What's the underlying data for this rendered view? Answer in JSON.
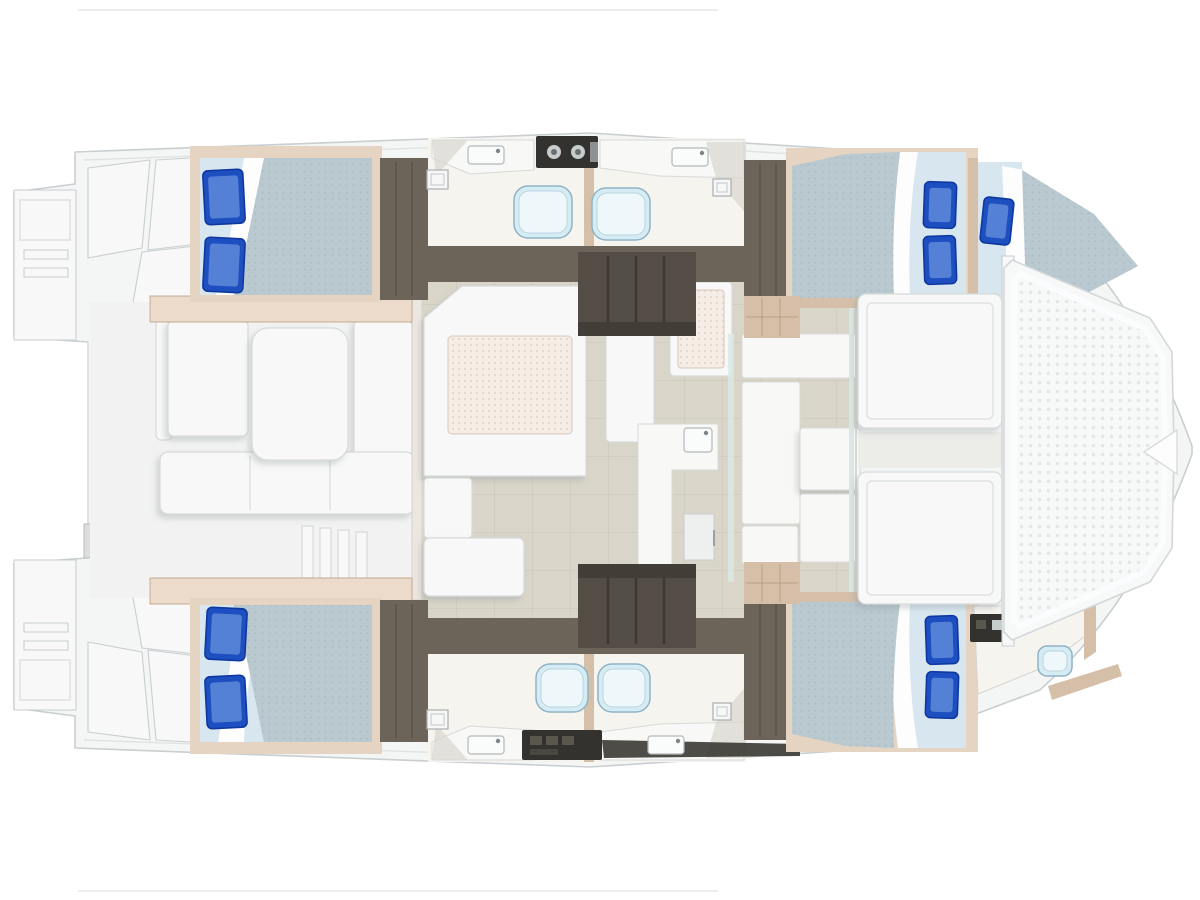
{
  "diagram": {
    "type": "yacht-floor-plan",
    "description": "Top-down interior layout plan of a sailing catamaran, bow to the right",
    "orientation": {
      "bow": "right",
      "stern": "left"
    },
    "rooms": [
      {
        "id": "aft-cockpit",
        "desc": "aft cockpit with table, benches and transom steps"
      },
      {
        "id": "salon",
        "desc": "salon with U-shaped settee and table"
      },
      {
        "id": "galley",
        "desc": "galley counters with sink and refrigerator"
      },
      {
        "id": "port-aft-cabin",
        "desc": "double berth with two pillows"
      },
      {
        "id": "port-heads",
        "desc": "two bathroom compartments with toilets and basins"
      },
      {
        "id": "port-forward-cabin",
        "desc": "double berth with two pillows"
      },
      {
        "id": "port-forepeak-berth",
        "desc": "single berth with one pillow"
      },
      {
        "id": "starboard-aft-cabin",
        "desc": "double berth with two pillows"
      },
      {
        "id": "starboard-heads",
        "desc": "two bathroom compartments with toilets and basins"
      },
      {
        "id": "starboard-forward-cabin",
        "desc": "double berth with two pillows"
      },
      {
        "id": "starboard-forward-head",
        "desc": "small bathroom with toilet and vanity"
      },
      {
        "id": "forward-cockpit",
        "desc": "forward cockpit with two lounge pads"
      },
      {
        "id": "trampoline",
        "desc": "bow trampoline net"
      }
    ]
  },
  "palette": {
    "background": "#ffffff",
    "hull_fill": "#f4f5f5",
    "hull_stroke": "#c9ced1",
    "panel_line": "#dfe2e3",
    "deck_white": "#f7f8f7",
    "cockpit_sole": "#f1f2f1",
    "taupe": "#6d6459",
    "taupe_dark": "#544d45",
    "step_line": "#3c3731",
    "wood_light": "#e6d4c3",
    "wood_mid": "#d5bfa9",
    "wood_dark": "#b99c80",
    "trim_pink": "#ecdacb",
    "floor_beige": "#d9d5c9",
    "floor_grid": "#c8c4b7",
    "bathroom_floor": "#f6f4ef",
    "bath_wedge": "#d9d5cf",
    "mattress_pale": "#d7e6ef",
    "duvet": "#b9c9cf",
    "duvet_dot": "#a9bcc3",
    "sheet": "#fdfdfe",
    "pillow": "#1d4fc0",
    "pillow_dark": "#0f37a0",
    "pillow_light": "#5e8ad8",
    "toilet_fill": "#d6ecf5",
    "toilet_stroke": "#8fb3c4",
    "toilet_lid": "#eef8fb",
    "counter_white": "#f8f8f6",
    "counter_stroke": "#d6dad9",
    "stove_dark": "#34322e",
    "knob": "#c7cccd",
    "table_pad": "#f4ece5",
    "table_dot": "#e3d2c6",
    "table_stroke": "#d8c9ba",
    "tramp_fill": "#f7f8f8",
    "tramp_dot": "#e4e7e7",
    "tramp_stroke": "#d3d7d9",
    "glazing": "#d9e8e5",
    "rig_line": "#ebecec"
  },
  "fixtures": {
    "pillows": [
      {
        "x": 204,
        "y": 170,
        "w": 40,
        "h": 54,
        "r": -3
      },
      {
        "x": 204,
        "y": 238,
        "w": 40,
        "h": 54,
        "r": 3
      },
      {
        "x": 206,
        "y": 608,
        "w": 40,
        "h": 52,
        "r": 3
      },
      {
        "x": 206,
        "y": 676,
        "w": 40,
        "h": 52,
        "r": -3
      },
      {
        "x": 924,
        "y": 182,
        "w": 32,
        "h": 46,
        "r": 2
      },
      {
        "x": 924,
        "y": 236,
        "w": 32,
        "h": 48,
        "r": -2
      },
      {
        "x": 982,
        "y": 198,
        "w": 30,
        "h": 46,
        "r": 6
      },
      {
        "x": 926,
        "y": 616,
        "w": 32,
        "h": 48,
        "r": -2
      },
      {
        "x": 926,
        "y": 672,
        "w": 32,
        "h": 46,
        "r": 2
      }
    ],
    "toilets": [
      {
        "x": 514,
        "y": 186,
        "w": 58,
        "h": 52
      },
      {
        "x": 592,
        "y": 188,
        "w": 58,
        "h": 52
      },
      {
        "x": 536,
        "y": 664,
        "w": 52,
        "h": 48
      },
      {
        "x": 598,
        "y": 664,
        "w": 52,
        "h": 48
      },
      {
        "x": 1038,
        "y": 646,
        "w": 34,
        "h": 30
      }
    ],
    "sinks": [
      {
        "x": 468,
        "y": 146,
        "w": 36,
        "h": 18
      },
      {
        "x": 672,
        "y": 148,
        "w": 36,
        "h": 18
      },
      {
        "x": 468,
        "y": 736,
        "w": 36,
        "h": 18
      },
      {
        "x": 648,
        "y": 736,
        "w": 36,
        "h": 18
      },
      {
        "x": 684,
        "y": 428,
        "w": 28,
        "h": 24
      }
    ],
    "hatches": [
      {
        "x": 427,
        "y": 170,
        "w": 21,
        "h": 19
      },
      {
        "x": 713,
        "y": 179,
        "w": 18,
        "h": 17
      },
      {
        "x": 427,
        "y": 710,
        "w": 21,
        "h": 19
      },
      {
        "x": 713,
        "y": 703,
        "w": 18,
        "h": 17
      }
    ]
  }
}
